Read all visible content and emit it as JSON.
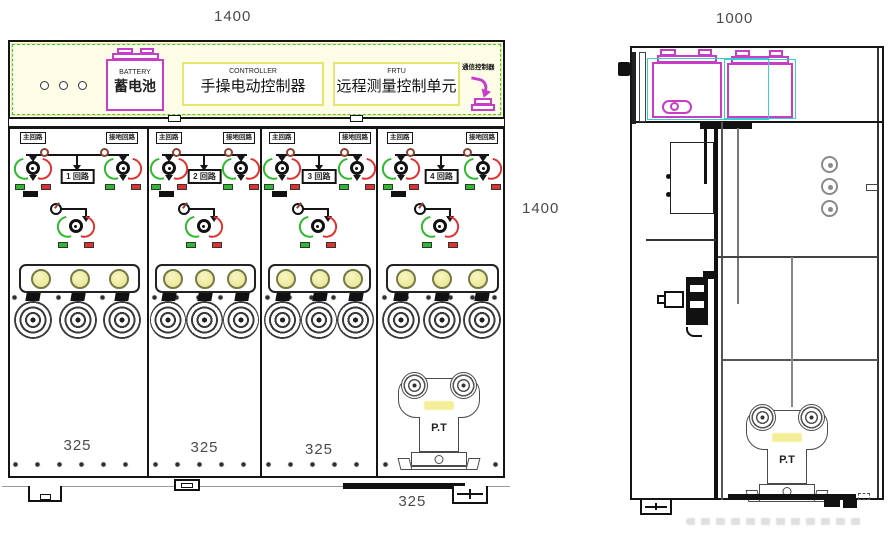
{
  "front": {
    "dim_width": "1400",
    "dim_height": "1400",
    "panel": {
      "battery_en": "BATTERY",
      "battery_cn": "蓄电池",
      "controller_en": "CONTROLLER",
      "controller_cn": "手操电动控制器",
      "frtu_en": "FRTU",
      "frtu_cn": "远程测量控制单元",
      "comm_label": "通信控制器"
    },
    "compartments": [
      {
        "main_label": "主回路",
        "earth_label": "接地回路",
        "circuit": "1 回路",
        "width_dim": "325"
      },
      {
        "main_label": "主回路",
        "earth_label": "接地回路",
        "circuit": "2 回路",
        "width_dim": "325"
      },
      {
        "main_label": "主回路",
        "earth_label": "接地回路",
        "circuit": "3 回路",
        "width_dim": "325"
      },
      {
        "main_label": "主回路",
        "earth_label": "接地回路",
        "circuit": "4 回路",
        "width_dim": "325"
      }
    ]
  },
  "side": {
    "dim_width": "1000"
  },
  "pt": {
    "front_label": "P.T",
    "side_label": "P.T"
  },
  "colors": {
    "magenta": "#c83cc8",
    "green": "#2eb82e",
    "red": "#e03131",
    "cyan": "#35cfcf",
    "panel_fill": "#fdfce6",
    "lamp_fill": "#e6e288",
    "dim_text": "#4a4a4a"
  }
}
